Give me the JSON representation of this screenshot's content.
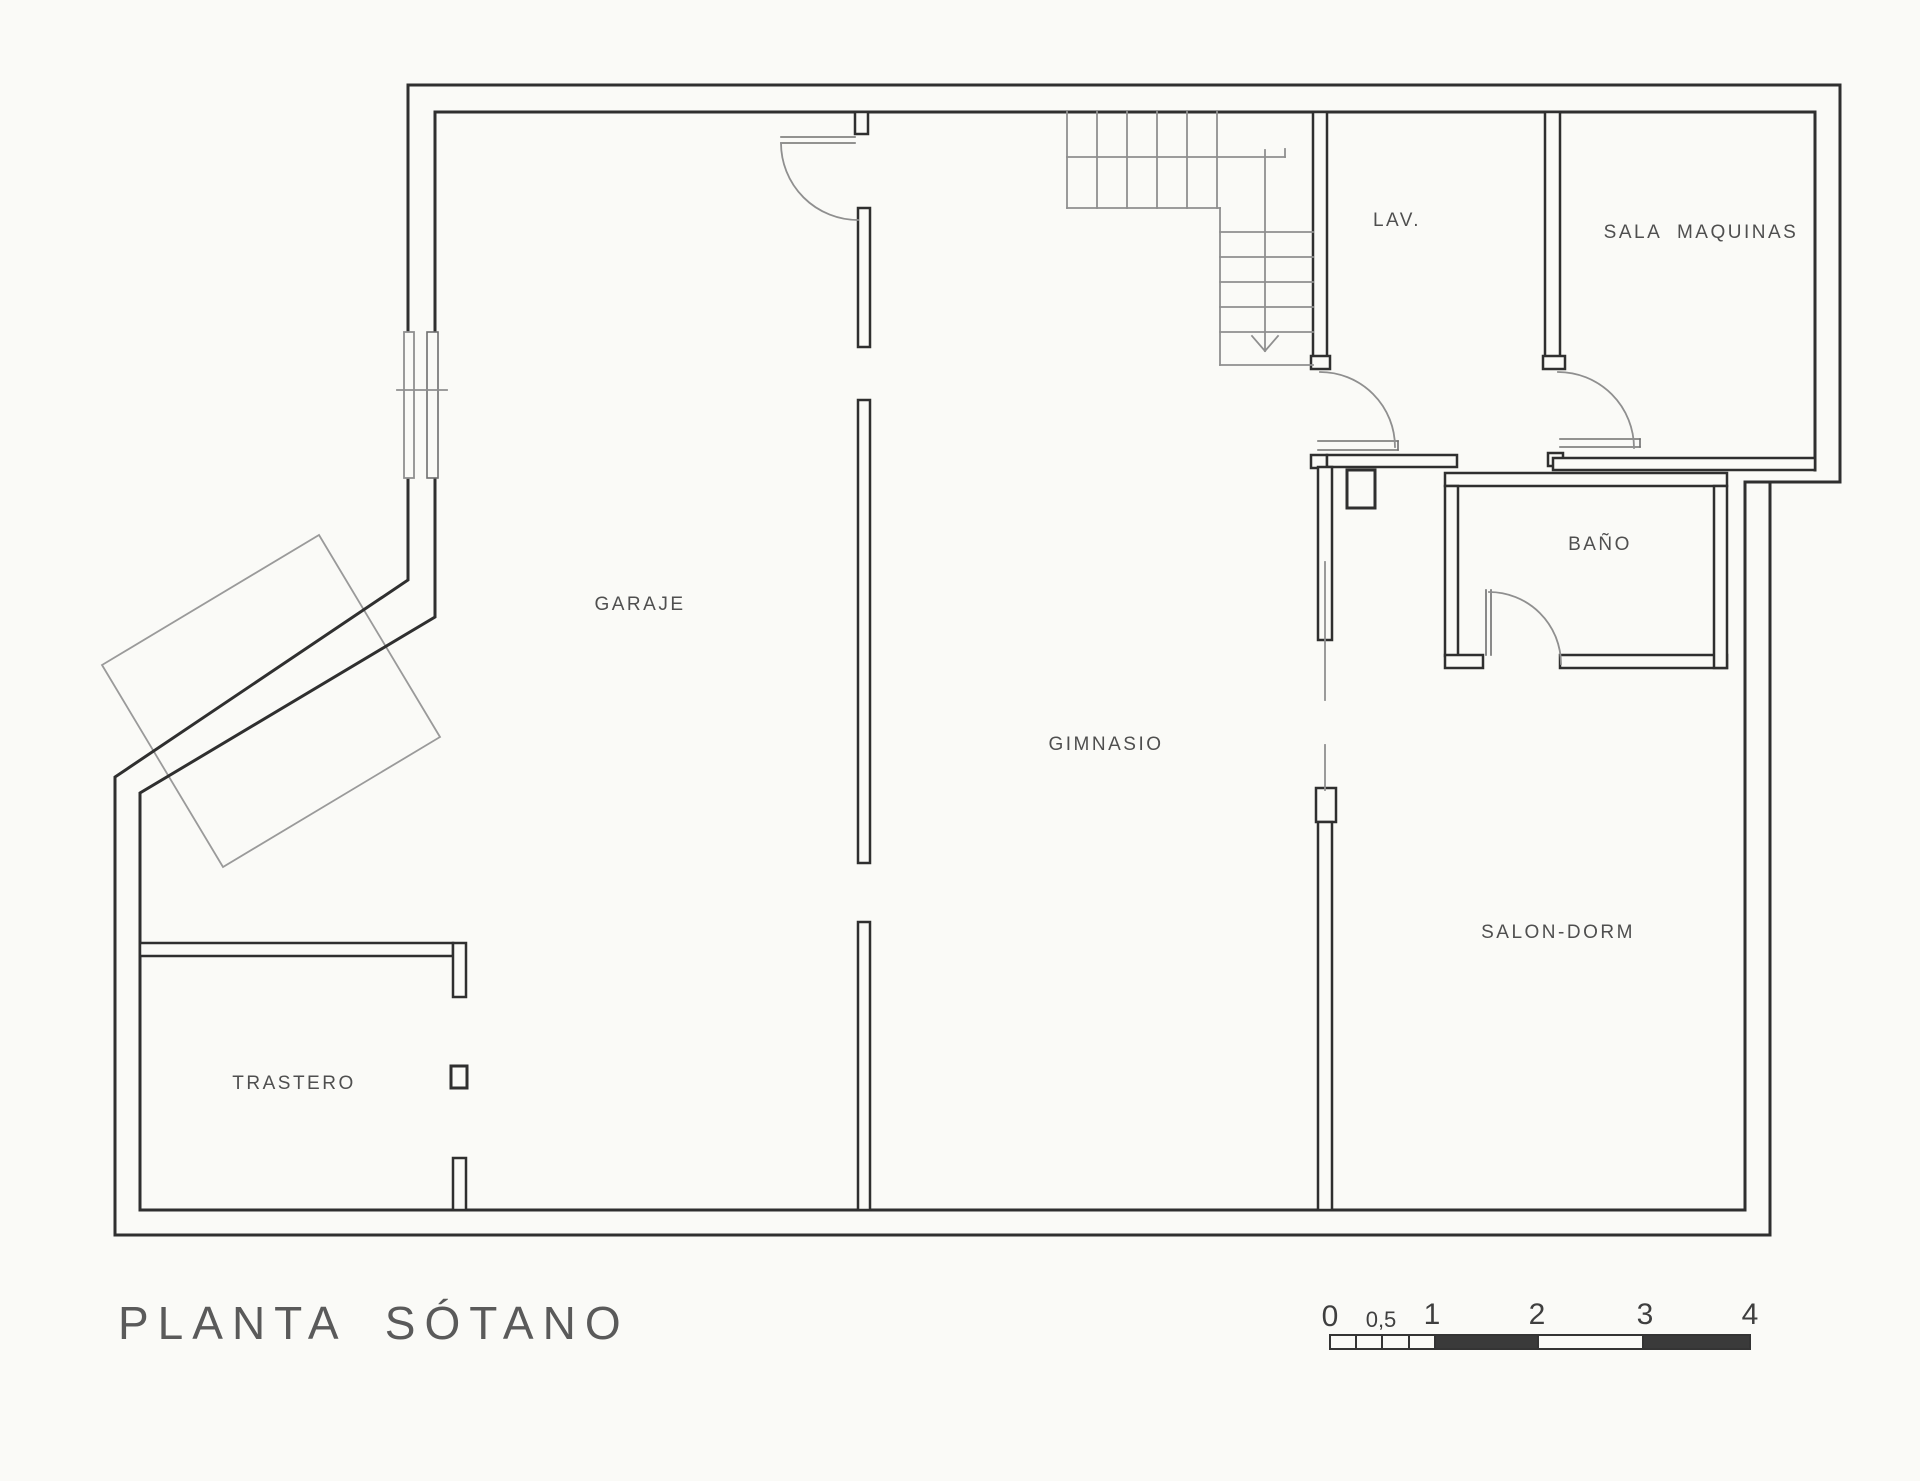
{
  "title": "PLANTA SÓTANO",
  "rooms": {
    "garaje": "GARAJE",
    "gimnasio": "GIMNASIO",
    "trastero": "TRASTERO",
    "salon_dorm": "SALON-DORM",
    "bano": "BAÑO",
    "lav": "LAV.",
    "sala_maquinas": "SALA MAQUINAS"
  },
  "scale_bar": {
    "labels": [
      "0",
      "0,5",
      "1",
      "2",
      "3",
      "4"
    ]
  },
  "colors": {
    "wall": "#2f2f2f",
    "light_line": "#8f8f8f",
    "paper": "#fafaf7",
    "label_text": "#4f4f4f"
  }
}
